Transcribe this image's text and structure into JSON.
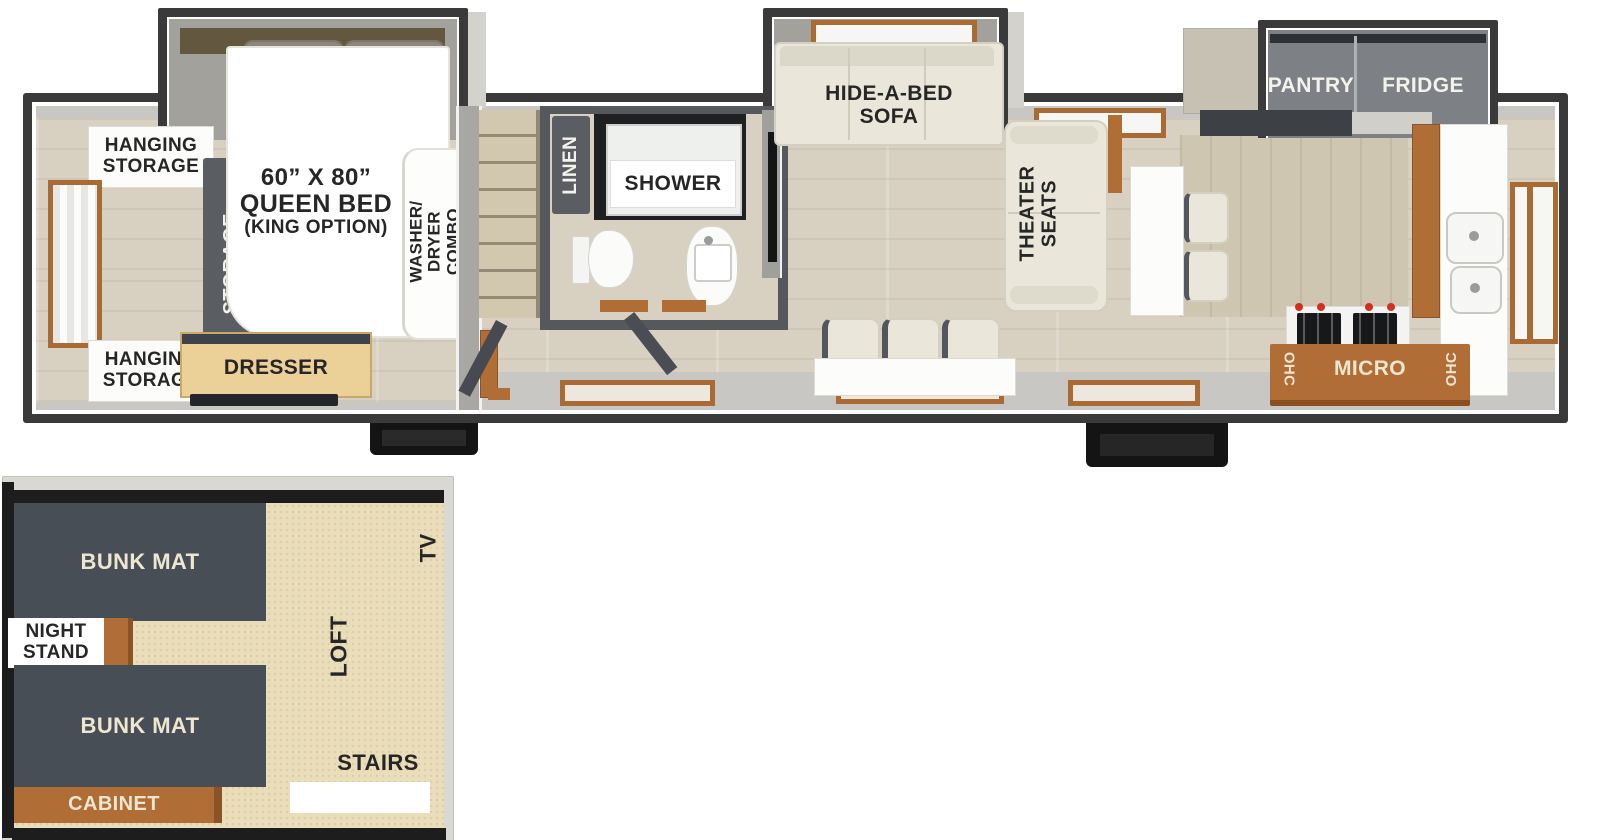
{
  "palette": {
    "wall_dark": "#3a3a3a",
    "wall_light": "#c8c7c3",
    "floor_wood": "#d8d1c2",
    "floor_tan": "#eaddb9",
    "accent_brown": "#b06d35",
    "cabinet_gray": "#5a5e63",
    "furniture_cream": "#eae7da",
    "bunk_mat_dark": "#484e56",
    "counter_charcoal": "#3d4146",
    "flame_orange": "#ff8a1e"
  },
  "main": {
    "bedroom": {
      "hanging_storage_top": "HANGING\nSTORAGE",
      "hanging_storage_bottom": "HANGING\nSTORAGE",
      "storage": "STORAGE",
      "fireplace": "FIREPLACE",
      "dresser": "DRESSER",
      "bed_size": "60” X 80”",
      "bed_name": "QUEEN BED",
      "bed_option": "(KING OPTION)",
      "washer_dryer": "WASHER/\nDRYER\nCOMBO"
    },
    "bath": {
      "linen": "LINEN",
      "shower": "SHOWER"
    },
    "living": {
      "sofa": "HIDE-A-BED\nSOFA",
      "theater": "THEATER\nSEATS"
    },
    "kitchen": {
      "pantry": "PANTRY",
      "fridge": "FRIDGE",
      "ohc_left": "OHC",
      "micro": "MICRO",
      "ohc_right": "OHC"
    }
  },
  "loft": {
    "bunk_top": "BUNK MAT",
    "bunk_bottom": "BUNK MAT",
    "night_stand": "NIGHT\nSTAND",
    "cabinet": "CABINET",
    "loft": "LOFT",
    "tv": "TV",
    "stairs": "STAIRS"
  }
}
